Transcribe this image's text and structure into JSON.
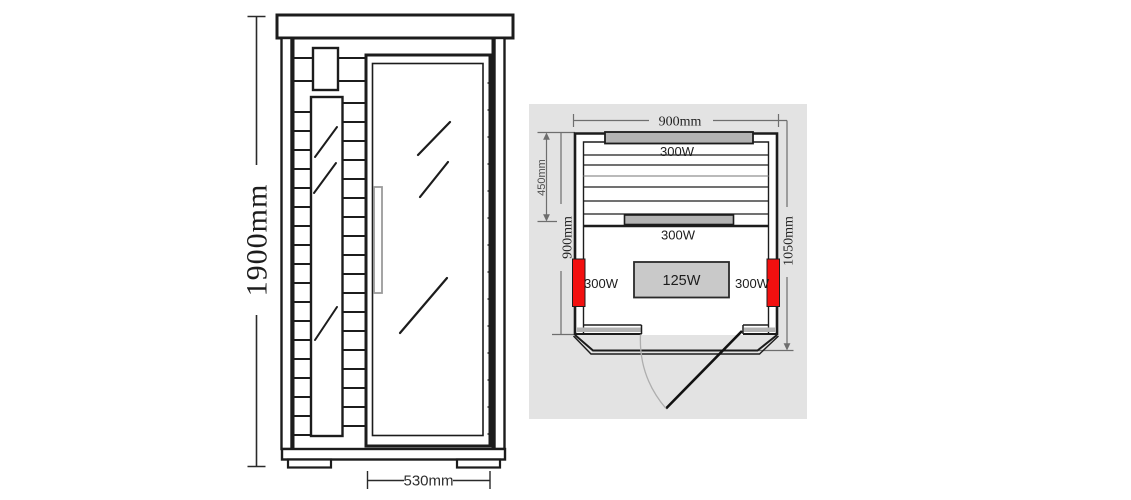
{
  "title": "Sauna dimension diagram",
  "front_view": {
    "height_label": "1900mm",
    "door_width_label": "530mm"
  },
  "top_view": {
    "width_label": "900mm",
    "bench_depth_label": "450mm",
    "inner_depth_label": "900mm",
    "total_depth_label": "1050mm",
    "back_heater_label": "300W",
    "bench_heater_label": "300W",
    "left_heater_label": "300W",
    "right_heater_label": "300W",
    "floor_heater_label": "125W"
  },
  "colors": {
    "line": "#1c1c1c",
    "panel_background": "#e3e3e3",
    "heater_bar_gray": "#b3b3b3",
    "floor_heater_gray": "#c9c9c9",
    "heater_red": "#f2100f",
    "dimension_line": "#6e6e6e"
  }
}
